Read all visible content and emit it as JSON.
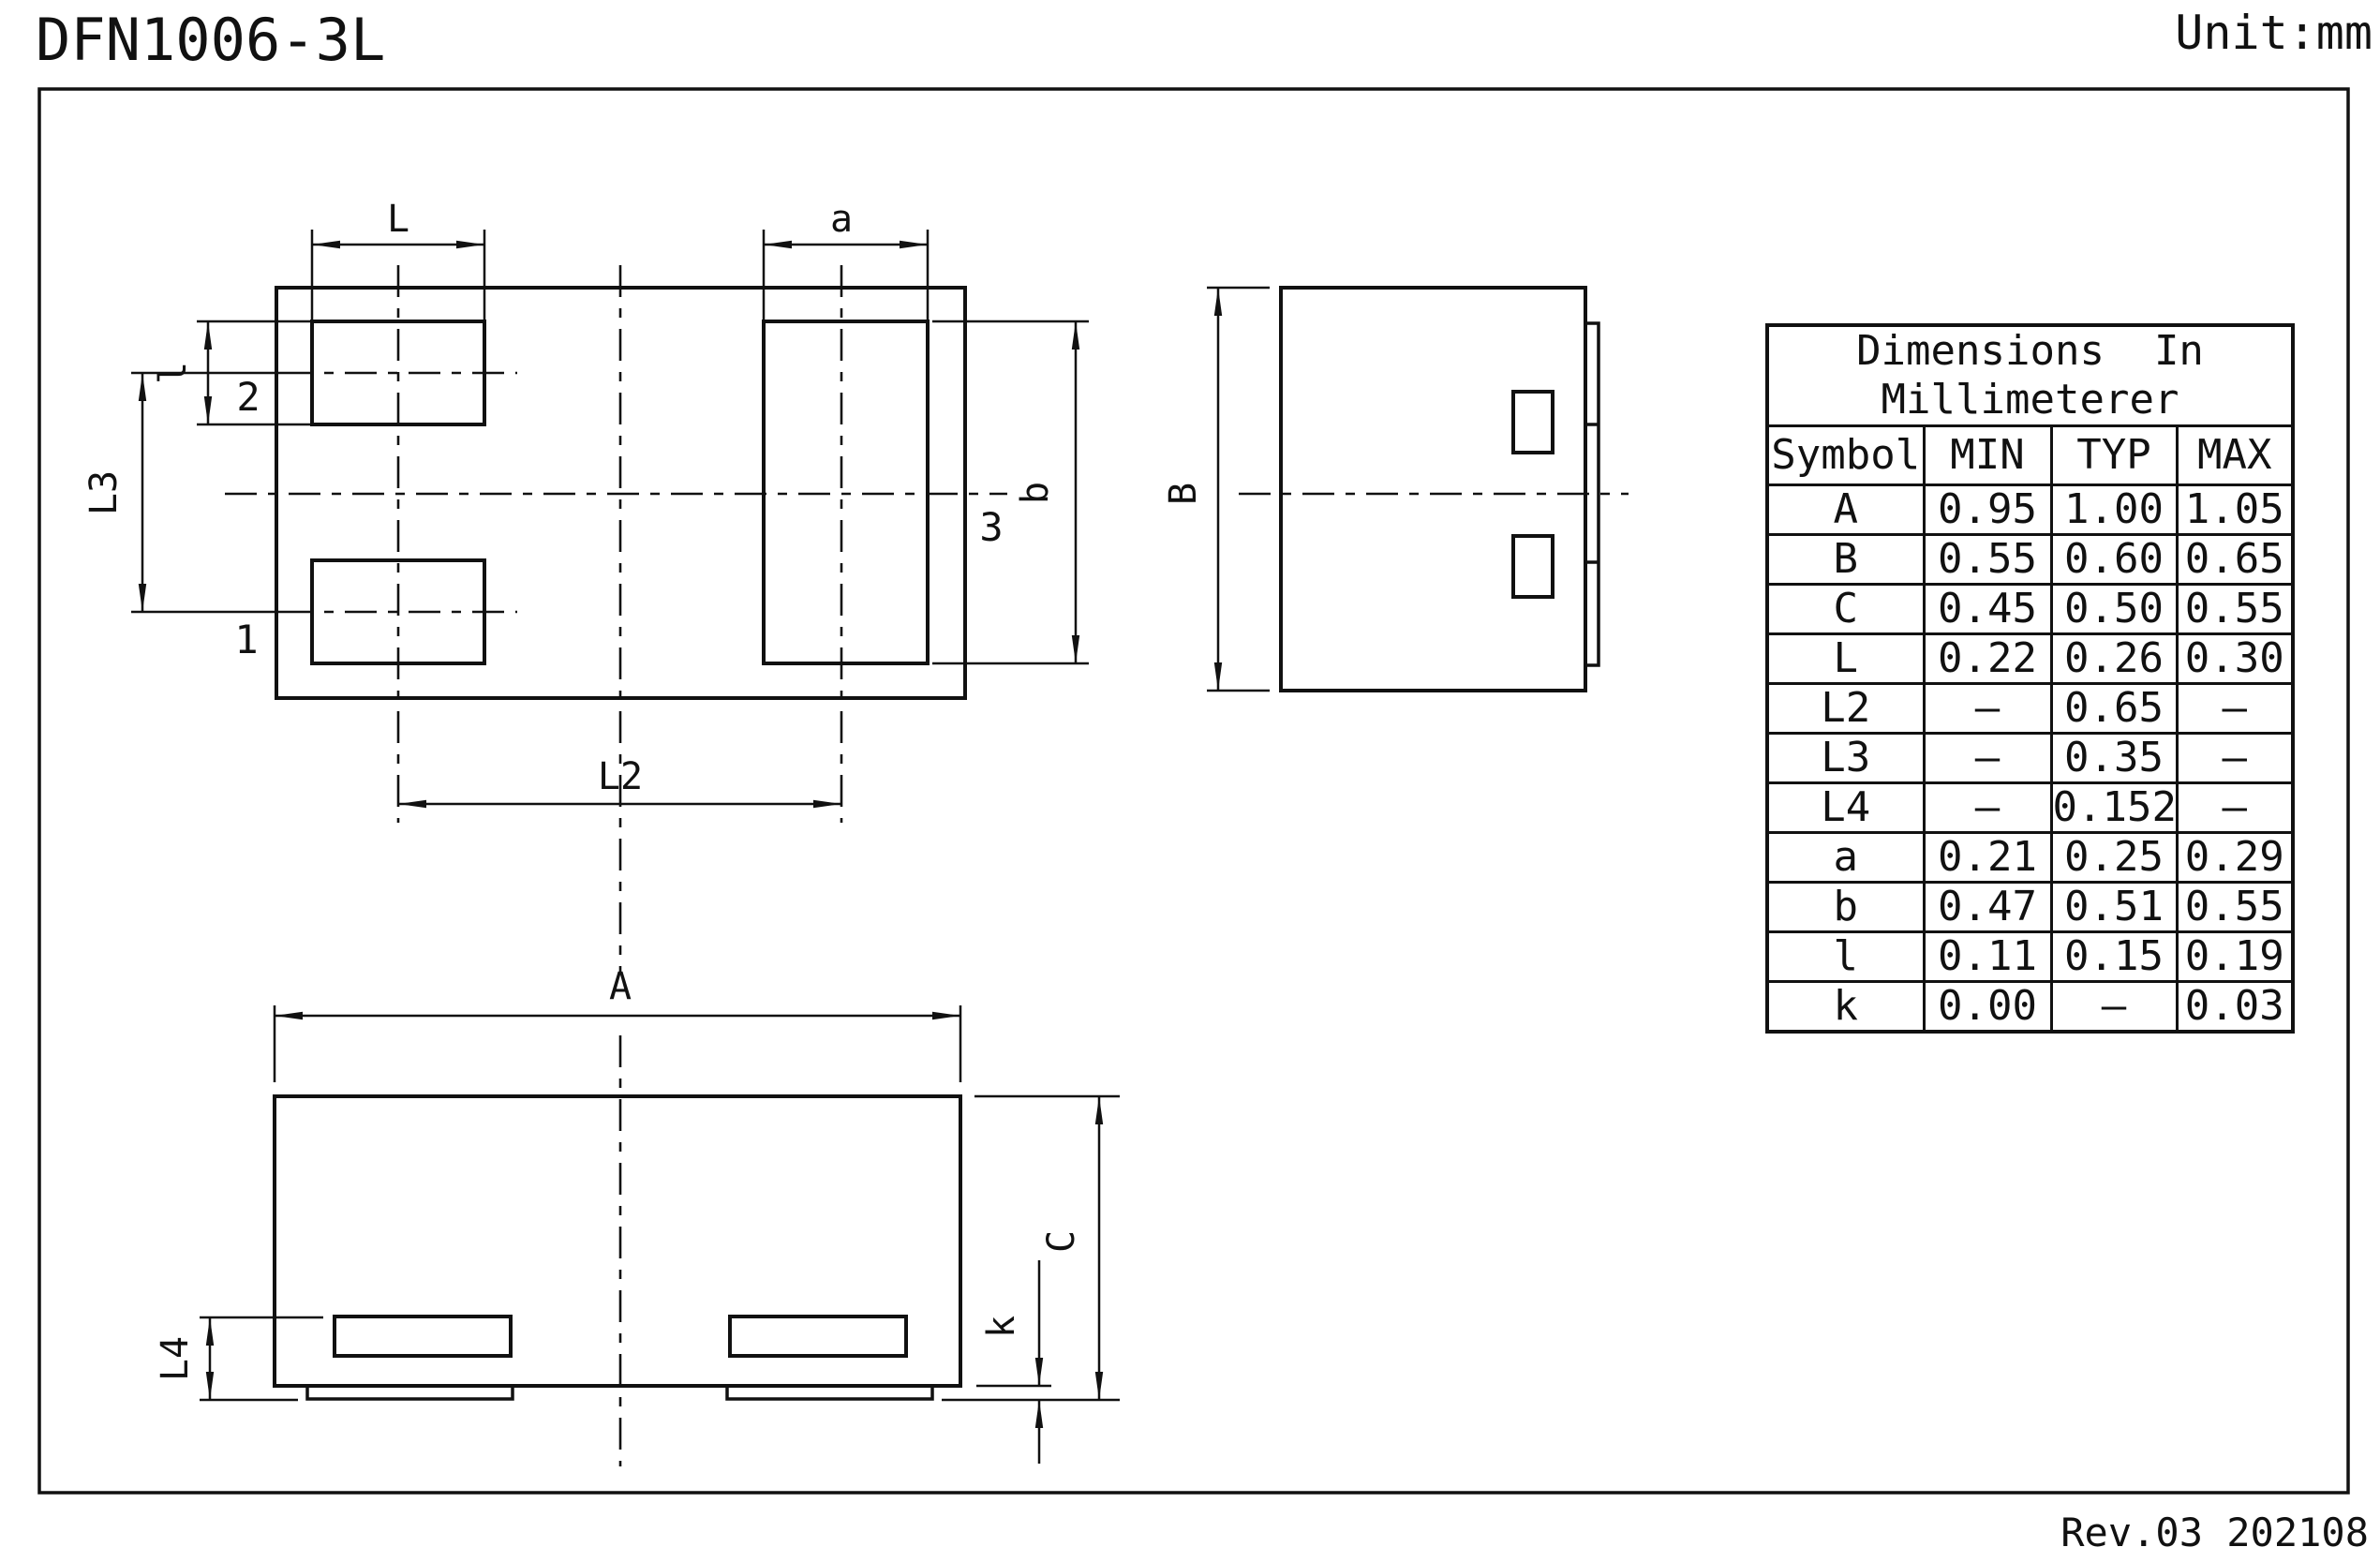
{
  "page": {
    "title": "DFN1006-3L",
    "unit_label": "Unit:mm",
    "revision": "Rev.03  202108"
  },
  "drawing": {
    "line_color": "#111111",
    "top_view": {
      "pin_labels": {
        "pin1": "1",
        "pin2": "2",
        "pin3": "3"
      },
      "dims": {
        "L": "L",
        "a": "a",
        "l": "l",
        "L3": "L3",
        "b": "b",
        "L2": "L2"
      }
    },
    "side_view": {
      "dims": {
        "B": "B"
      }
    },
    "bottom_view": {
      "dims": {
        "A": "A",
        "C": "C",
        "L4": "L4",
        "k": "k"
      }
    }
  },
  "table": {
    "title_line1": "Dimensions  In",
    "title_line2": "Millimeterer",
    "columns": [
      "Symbol",
      "MIN",
      "TYP",
      "MAX"
    ],
    "rows": [
      [
        "A",
        "0.95",
        "1.00",
        "1.05"
      ],
      [
        "B",
        "0.55",
        "0.60",
        "0.65"
      ],
      [
        "C",
        "0.45",
        "0.50",
        "0.55"
      ],
      [
        "L",
        "0.22",
        "0.26",
        "0.30"
      ],
      [
        "L2",
        "–",
        "0.65",
        "–"
      ],
      [
        "L3",
        "–",
        "0.35",
        "–"
      ],
      [
        "L4",
        "–",
        "0.152",
        "–"
      ],
      [
        "a",
        "0.21",
        "0.25",
        "0.29"
      ],
      [
        "b",
        "0.47",
        "0.51",
        "0.55"
      ],
      [
        "l",
        "0.11",
        "0.15",
        "0.19"
      ],
      [
        "k",
        "0.00",
        "–",
        "0.03"
      ]
    ]
  }
}
